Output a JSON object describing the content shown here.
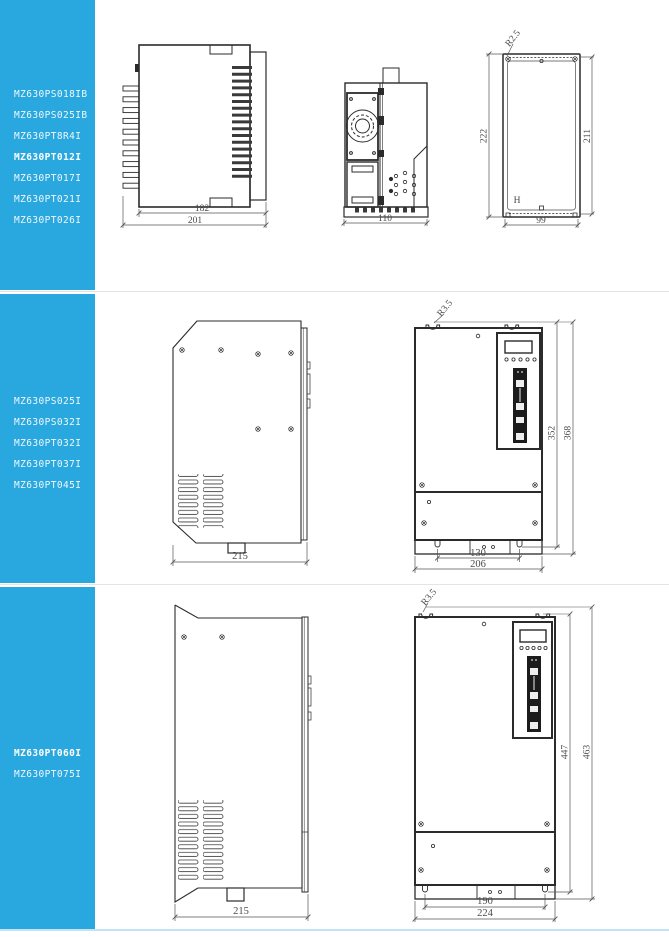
{
  "sidebar": {
    "bg_color": "#29A7DF",
    "groups": [
      {
        "models": [
          {
            "label": "MZ630PS018IB"
          },
          {
            "label": "MZ630PS025IB"
          },
          {
            "label": "MZ630PT8R4I"
          },
          {
            "label": "MZ630PT012I"
          },
          {
            "label": "MZ630PT017I"
          },
          {
            "label": "MZ630PT021I"
          },
          {
            "label": "MZ630PT026I"
          }
        ]
      },
      {
        "models": [
          {
            "label": "MZ630PS025I"
          },
          {
            "label": "MZ630PS032I"
          },
          {
            "label": "MZ630PT032I"
          },
          {
            "label": "MZ630PT037I"
          },
          {
            "label": "MZ630PT045I"
          }
        ]
      },
      {
        "models": [
          {
            "label": "MZ630PT060I"
          },
          {
            "label": "MZ630PT075I"
          }
        ]
      }
    ]
  },
  "drawings": {
    "row1": {
      "top_view": {
        "dim_body_width": "182",
        "dim_total_width": "201"
      },
      "side_view": {
        "dim_depth": "110"
      },
      "back_view": {
        "dim_total_height": "222",
        "dim_hole_height": "211",
        "dim_hole_width": "99",
        "corner_radius": "R2.5",
        "marking": "H"
      }
    },
    "row2": {
      "side_view": {
        "dim_depth": "215"
      },
      "front_view": {
        "corner_radius": "R3.5",
        "dim_hole_height": "352",
        "dim_total_height": "368",
        "dim_hole_width": "130",
        "dim_total_width": "206"
      }
    },
    "row3": {
      "side_view": {
        "dim_depth": "215"
      },
      "front_view": {
        "corner_radius": "R3.5",
        "dim_hole_height": "447",
        "dim_total_height": "463",
        "dim_hole_width": "190",
        "dim_total_width": "224"
      }
    }
  }
}
